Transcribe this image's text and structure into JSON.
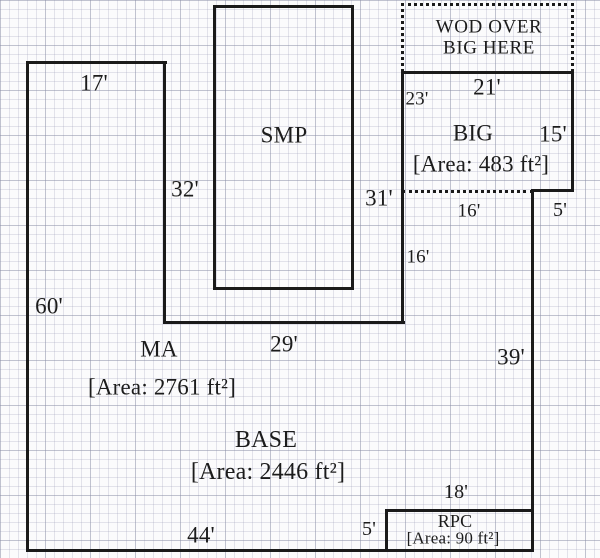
{
  "title": "Floor plan sketch",
  "rooms": {
    "smp": {
      "name": "SMP"
    },
    "big": {
      "name": "BIG",
      "area": "[Area: 483 ft²]"
    },
    "wod": {
      "line1": "WOD OVER",
      "line2": "BIG HERE"
    },
    "ma": {
      "name": "MA",
      "area": "[Area: 2761 ft²]"
    },
    "base": {
      "name": "BASE",
      "area": "[Area: 2446 ft²]"
    },
    "rpc": {
      "name": "RPC",
      "area": "[Area: 90 ft²]"
    }
  },
  "dims": {
    "top_left_width": "17'",
    "left_wing_height": "32'",
    "left_height": "60'",
    "ma_bottom_width": "29'",
    "mid_height": "31'",
    "big_bottom_width": "16'",
    "right_upper_height": "16'",
    "big_step_width": "5'",
    "big_left_height": "23'",
    "big_top_width": "21'",
    "big_right_height": "15'",
    "right_lower_height": "39'",
    "bottom_width": "44'",
    "rpc_height": "5'",
    "rpc_width": "18'"
  },
  "colors": {
    "wall": "#1a1a1a",
    "paper": "#fbfbfc",
    "grid_minor": "#dfe1ea",
    "grid_major": "#c9cbd8",
    "text": "#1c1c1c"
  }
}
